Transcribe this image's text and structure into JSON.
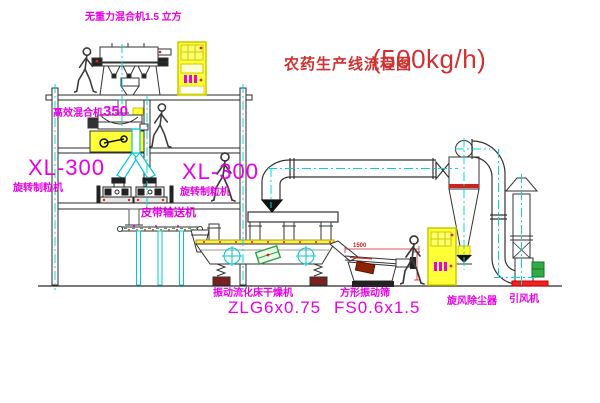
{
  "title": {
    "main": "农药生产线流程图",
    "capacity": "(500kg/h)"
  },
  "equipment_labels": {
    "gravity_free_mixer": "无重力混合机1.5 立方",
    "high_efficiency_mixer": "高效混合机",
    "high_efficiency_mixer_model": "350",
    "granulator_left": {
      "model": "XL-300",
      "name": "旋转制粒机"
    },
    "granulator_right": {
      "model": "XL-300",
      "name": "旋转制粒机"
    },
    "belt_conveyor": "皮带输送机",
    "fluid_bed_dryer": {
      "name": "振动流化床干燥机",
      "model": "ZLG6x0.75"
    },
    "square_sieve": {
      "name": "方形振动筛",
      "model": "FS0.6x1.5"
    },
    "cyclone": "旋风除尘器",
    "draft_fan": "引风机"
  },
  "dimensions": {
    "sieve_width": "1500"
  },
  "colors": {
    "label_magenta": "#e800e8",
    "title_red": "#d03030",
    "centerline_cyan": "#00d8d8",
    "equipment_yellow": "#ffff38",
    "line_dark": "#333333",
    "dimension_red": "#cc2222",
    "motor_green": "#2f9e44"
  }
}
